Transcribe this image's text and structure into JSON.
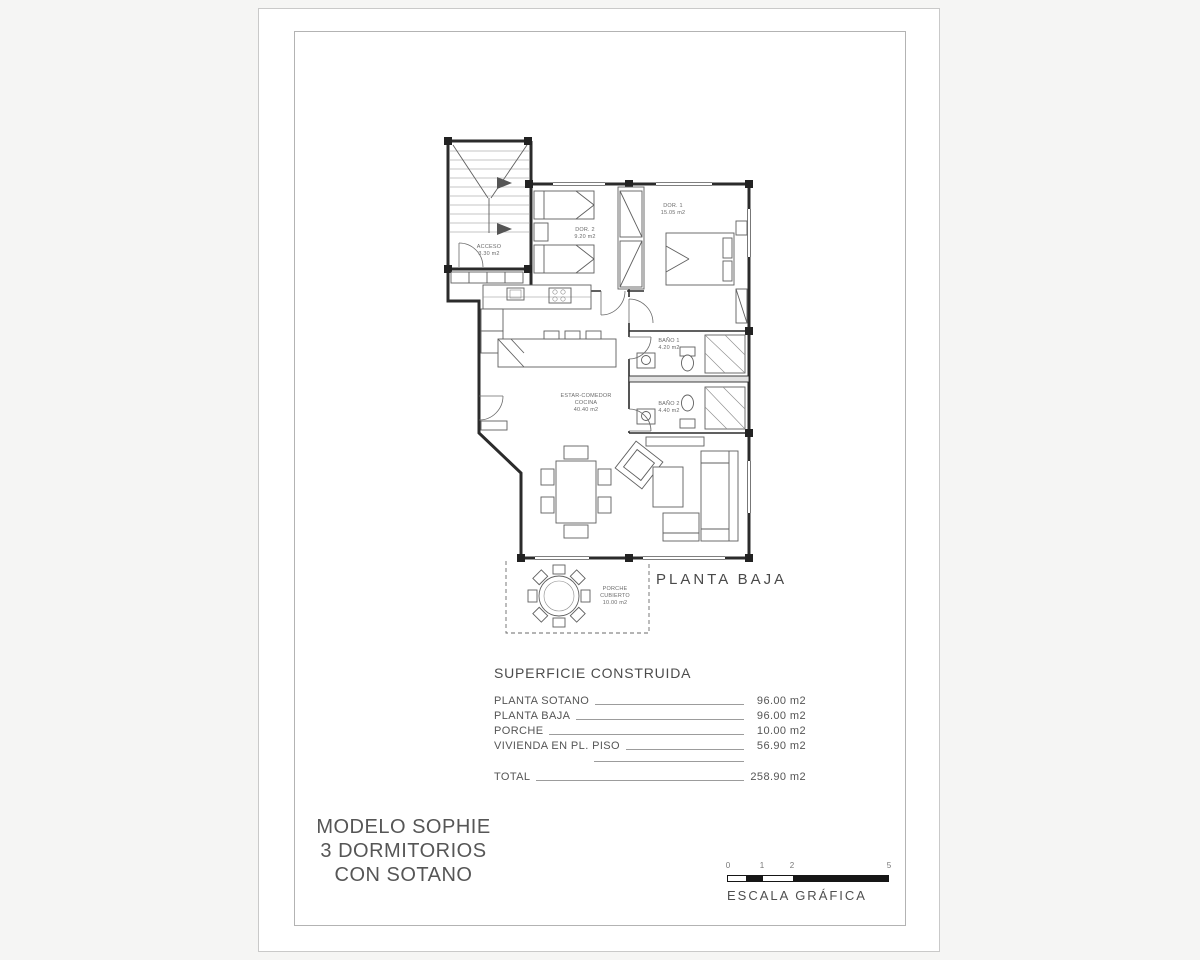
{
  "sheet": {
    "plan_label": "PLANTA BAJA",
    "rooms": {
      "acceso": {
        "name": "ACCESO",
        "area": "3.30 m2"
      },
      "dor2": {
        "name": "DOR. 2",
        "area": "9.20 m2"
      },
      "dor1": {
        "name": "DOR. 1",
        "area": "15.05 m2"
      },
      "bano1": {
        "name": "BAÑO 1",
        "area": "4.20 m2"
      },
      "bano2": {
        "name": "BAÑO 2",
        "area": "4.40 m2"
      },
      "estar": {
        "name": "ESTAR-COMEDOR",
        "name2": "COCINA",
        "area": "40.40 m2"
      },
      "porche": {
        "name": "PORCHE",
        "name2": "CUBIERTO",
        "area": "10.00 m2"
      }
    },
    "surface_table": {
      "title": "SUPERFICIE CONSTRUIDA",
      "rows": [
        {
          "label": "PLANTA SOTANO",
          "value": "96.00 m2"
        },
        {
          "label": "PLANTA BAJA",
          "value": "96.00 m2"
        },
        {
          "label": "PORCHE",
          "value": "10.00 m2"
        },
        {
          "label": "VIVIENDA EN PL. PISO",
          "value": "56.90 m2"
        }
      ],
      "total": {
        "label": "TOTAL",
        "value": "258.90 m2"
      }
    },
    "title_block": {
      "line1": "MODELO SOPHIE",
      "line2": "3 DORMITORIOS",
      "line3": "CON SOTANO"
    },
    "scale_bar": {
      "label": "ESCALA GRÁFICA",
      "ticks": [
        "0",
        "1",
        "2",
        "5"
      ]
    },
    "colors": {
      "wall": "#2b2b2b",
      "paper": "#ffffff",
      "ink": "#555555"
    }
  }
}
